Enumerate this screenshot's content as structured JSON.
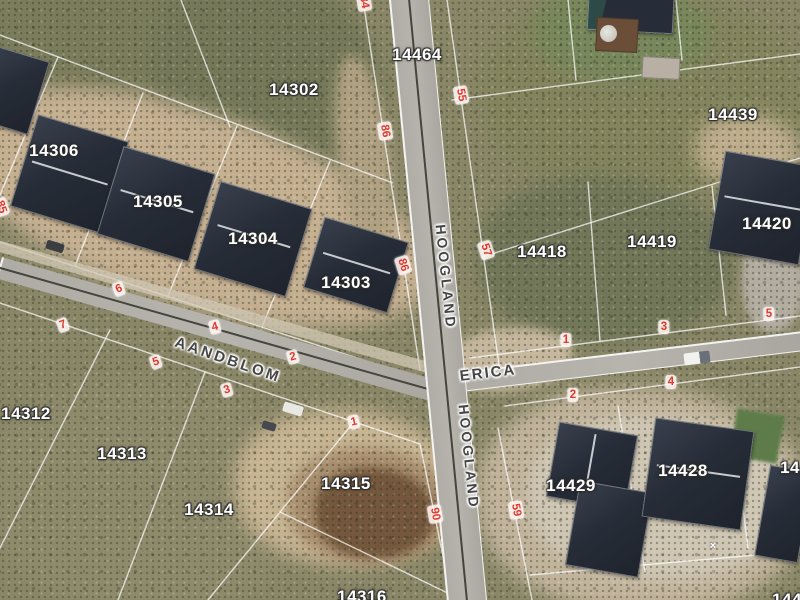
{
  "map": {
    "type": "aerial-cadastral-imagery",
    "colors": {
      "stand_number_red": "#e0392e",
      "parcel_label_white": "#ffffff",
      "street_label_gray": "#454545",
      "roof_dark": "#272d38",
      "road_gray": "#b0aea6",
      "veld_olive": "#8a8768",
      "sand_tan": "#c6b092"
    },
    "street_labels": [
      {
        "text": "AANDBLOM",
        "x": 228,
        "y": 360,
        "rot": 19,
        "size": 15,
        "ls": 3
      },
      {
        "text": "ERICA",
        "x": 488,
        "y": 373,
        "rot": -7,
        "size": 15,
        "ls": 2
      },
      {
        "text": "HOOGLAND",
        "x": 446,
        "y": 277,
        "rot": 84,
        "size": 14,
        "ls": 3
      },
      {
        "text": "HOOGLAND",
        "x": 469,
        "y": 457,
        "rot": 84,
        "size": 14,
        "ls": 3
      }
    ],
    "parcel_labels": [
      {
        "text": "14302",
        "x": 294,
        "y": 90
      },
      {
        "text": "14306",
        "x": 54,
        "y": 151
      },
      {
        "text": "14305",
        "x": 158,
        "y": 202
      },
      {
        "text": "14304",
        "x": 253,
        "y": 239
      },
      {
        "text": "14303",
        "x": 346,
        "y": 283
      },
      {
        "text": "14464",
        "x": 417,
        "y": 55
      },
      {
        "text": "14439",
        "x": 733,
        "y": 115
      },
      {
        "text": "14418",
        "x": 542,
        "y": 252
      },
      {
        "text": "14419",
        "x": 652,
        "y": 242
      },
      {
        "text": "14420",
        "x": 767,
        "y": 224
      },
      {
        "text": "14312",
        "x": 26,
        "y": 414
      },
      {
        "text": "14313",
        "x": 122,
        "y": 454
      },
      {
        "text": "14314",
        "x": 209,
        "y": 510
      },
      {
        "text": "14315",
        "x": 346,
        "y": 484
      },
      {
        "text": "14316",
        "x": 362,
        "y": 597,
        "partial": true
      },
      {
        "text": "14429",
        "x": 571,
        "y": 486
      },
      {
        "text": "14428",
        "x": 683,
        "y": 471
      },
      {
        "text": "1442",
        "x": 800,
        "y": 468,
        "partial": true
      },
      {
        "text": "1442",
        "x": 792,
        "y": 600,
        "partial": true
      }
    ],
    "stand_numbers": [
      {
        "text": "86",
        "x": 385,
        "y": 131,
        "rot": 80
      },
      {
        "text": "55",
        "x": 461,
        "y": 95,
        "rot": 80
      },
      {
        "text": "57",
        "x": 486,
        "y": 250,
        "rot": 72
      },
      {
        "text": "86",
        "x": 403,
        "y": 265,
        "rot": 72
      },
      {
        "text": "90",
        "x": 435,
        "y": 514,
        "rot": 80
      },
      {
        "text": "59",
        "x": 516,
        "y": 510,
        "rot": 80
      },
      {
        "text": "6",
        "x": 119,
        "y": 289,
        "rot": -20
      },
      {
        "text": "4",
        "x": 215,
        "y": 327,
        "rot": -15
      },
      {
        "text": "2",
        "x": 293,
        "y": 357,
        "rot": -15
      },
      {
        "text": "7",
        "x": 63,
        "y": 325,
        "rot": -20
      },
      {
        "text": "5",
        "x": 156,
        "y": 362,
        "rot": -18
      },
      {
        "text": "3",
        "x": 227,
        "y": 390,
        "rot": -15
      },
      {
        "text": "1",
        "x": 354,
        "y": 422,
        "rot": -12
      },
      {
        "text": "1",
        "x": 566,
        "y": 340,
        "rot": 0
      },
      {
        "text": "3",
        "x": 664,
        "y": 327,
        "rot": 0
      },
      {
        "text": "5",
        "x": 769,
        "y": 314,
        "rot": 0
      },
      {
        "text": "2",
        "x": 573,
        "y": 395,
        "rot": 0
      },
      {
        "text": "4",
        "x": 671,
        "y": 382,
        "rot": 0
      },
      {
        "text": "84",
        "x": 364,
        "y": 2,
        "rot": 80,
        "partial": true
      },
      {
        "text": "85",
        "x": 1,
        "y": 207,
        "rot": 72,
        "partial": true
      }
    ],
    "marks": [
      {
        "text": "×",
        "x": 713,
        "y": 546
      }
    ]
  }
}
